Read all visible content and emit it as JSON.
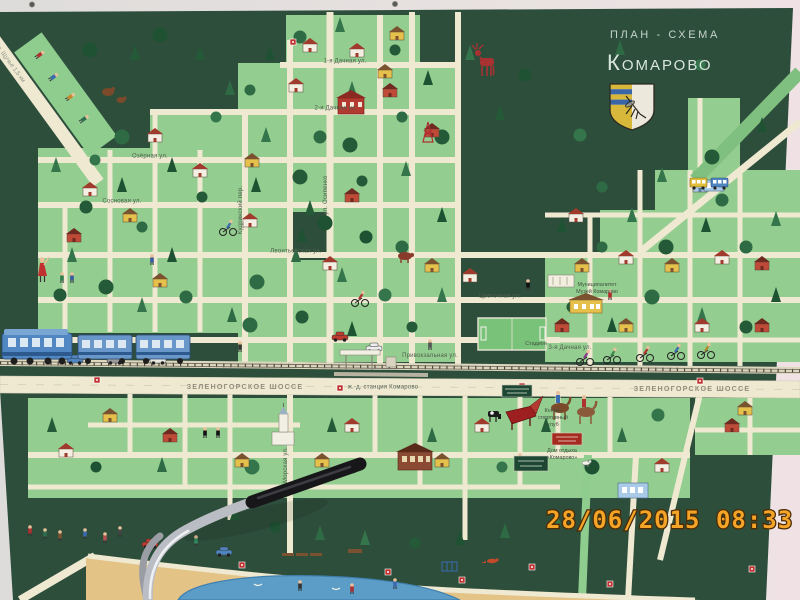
{
  "header": {
    "plan_label": "ПЛАН - СХЕМА",
    "title": "Комарово"
  },
  "datestamp": "28/06/2015 08:33",
  "highway": {
    "left": "ЗЕЛЕНОГОРСКОЕ ШОССЕ",
    "right": "ЗЕЛЕНОГОРСКОЕ ШОССЕ",
    "station": "ж.-д. станция Комарово"
  },
  "streets": {
    "lake_road": "на оз. Щучье 1,5 км",
    "dachnaya1": "1-я Дачная ул.",
    "dachnaya2": "2-я Дачная ул.",
    "dachnaya3": "3-я Дачная ул.",
    "ozernaya": "Озёрная ул.",
    "sosnovaya": "Сосновая ул.",
    "leontievskaya": "Леонтьевская ул.",
    "tsvetochnaya": "Цветочная ул.",
    "osipenko": "ул. Осипенко",
    "kudrinsky": "Кудринский пер.",
    "privokzalnaya": "Привокзальная ул.",
    "morskaya": "Морская ул."
  },
  "pois": {
    "municipality_line1": "Муниципалитет",
    "municipality_line2": "Музей Комарово",
    "stadium": "Стадион",
    "rest_house_line1": "Дом отдыха",
    "rest_house_line2": "«Комарово»",
    "equestrian_line1": "Конно-",
    "equestrian_line2": "спортивный",
    "equestrian_line3": "клуб"
  },
  "colors": {
    "board_green": "#2e4e3c",
    "block_green": "#93cd8f",
    "road_cream": "#efe9d2",
    "sand": "#e4c387",
    "water": "#5c9dc8",
    "datestamp_orange": "#f4a427",
    "accent_red": "#b03030",
    "title_text": "#d8e6dc"
  },
  "icons": {
    "crest-icon": "komarovo-shield-with-mosquito",
    "train-icon": "suburban-train",
    "moose-icon": "red-moose",
    "stadium-icon": "football-field",
    "piano-icon": "red-grand-piano",
    "horse-riders-icon": "horse-riders",
    "cyclist-icon": "cyclist",
    "handlebar-icon": "foreground-handlebar",
    "screw-icon": "board-screw"
  }
}
